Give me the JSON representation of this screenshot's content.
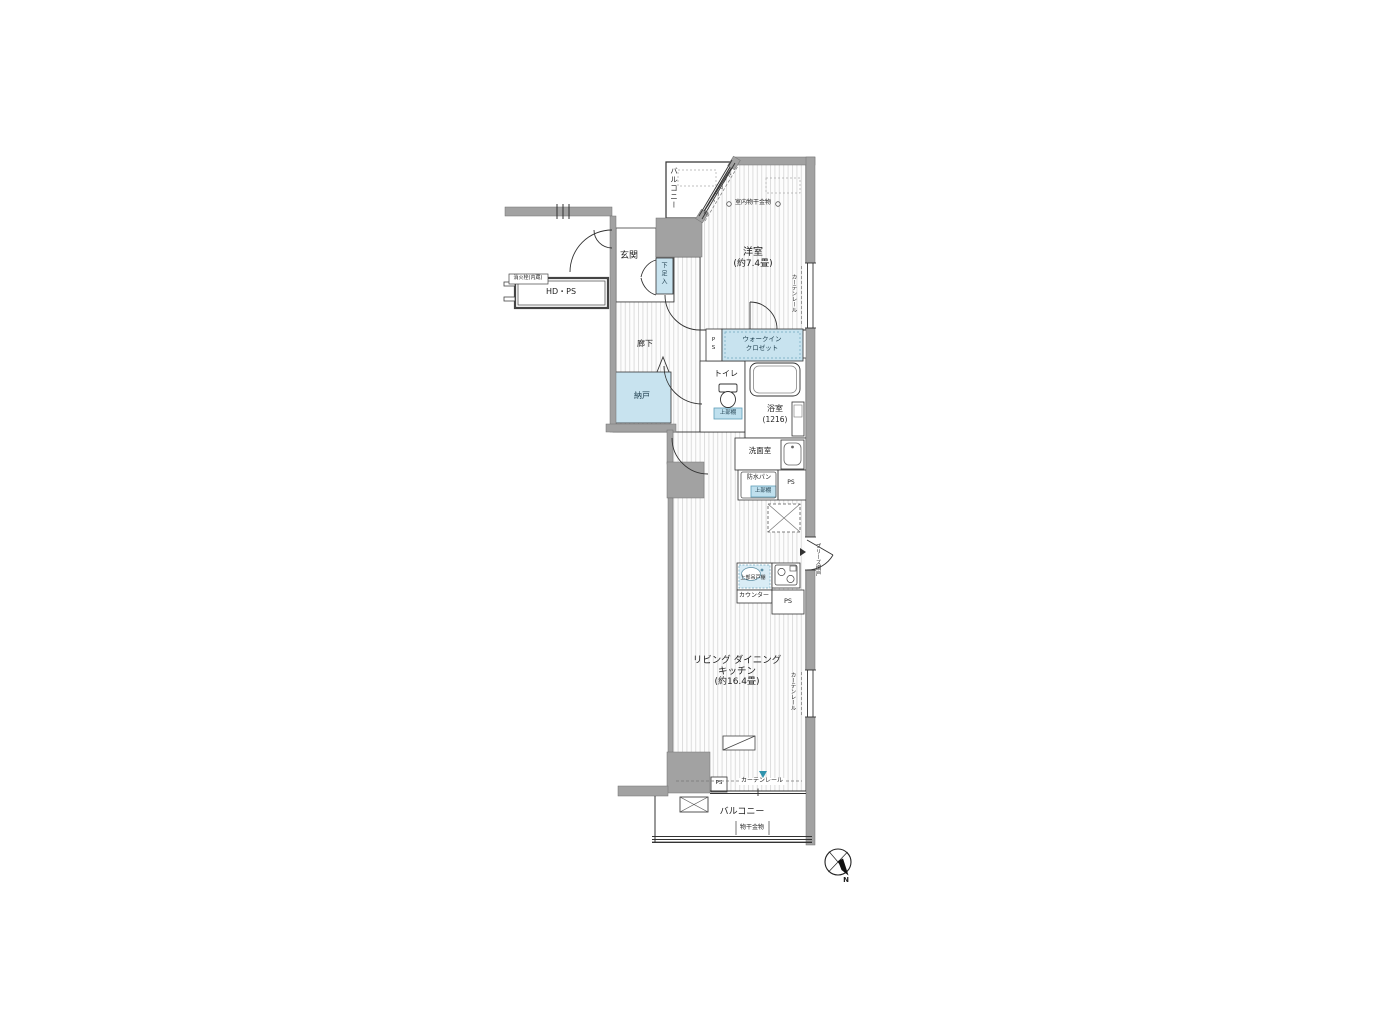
{
  "colors": {
    "wall_gray": "#a2a2a2",
    "fixture_blue": "#c8e3ef",
    "shelf_blue": "#bfe0ee",
    "accent_teal": "#2f93ad",
    "line": "#333333"
  },
  "labels": {
    "ps": "PS"
  },
  "rooms": {
    "balcony_top": {
      "label": "バルコニー"
    },
    "western_room": {
      "name": "洋室",
      "size": "(約7.4畳)"
    },
    "entrance": {
      "label": "玄関"
    },
    "shoe_box": {
      "label": "下足入"
    },
    "hdps": {
      "label": "HD・PS",
      "note": "消火栓(内蔵)"
    },
    "corridor": {
      "label": "廊下"
    },
    "storage": {
      "label": "納戸"
    },
    "wic": {
      "line1": "ウォークイン",
      "line2": "クロゼット"
    },
    "toilet": {
      "label": "トイレ",
      "shelf": "上部棚"
    },
    "bath": {
      "name": "浴室",
      "size": "(1216)"
    },
    "washroom": {
      "label": "洗面室"
    },
    "laundry": {
      "pan": "防水パン",
      "shelf": "上部棚"
    },
    "kitchen": {
      "cabinet": "上部吊戸棚",
      "counter": "カウンター"
    },
    "ldk": {
      "line1": "リビング ダイニング",
      "line2": "キッチン",
      "line3": "(約16.4畳)"
    },
    "balcony_bottom": {
      "label": "バルコニー",
      "drying": "物干金物"
    }
  },
  "annotations": {
    "indoor_drying": "室内物干金物",
    "curtain_rail": "カーテンレール",
    "breeze_screen": "ブリーズ網戸",
    "compass_n": "N"
  }
}
